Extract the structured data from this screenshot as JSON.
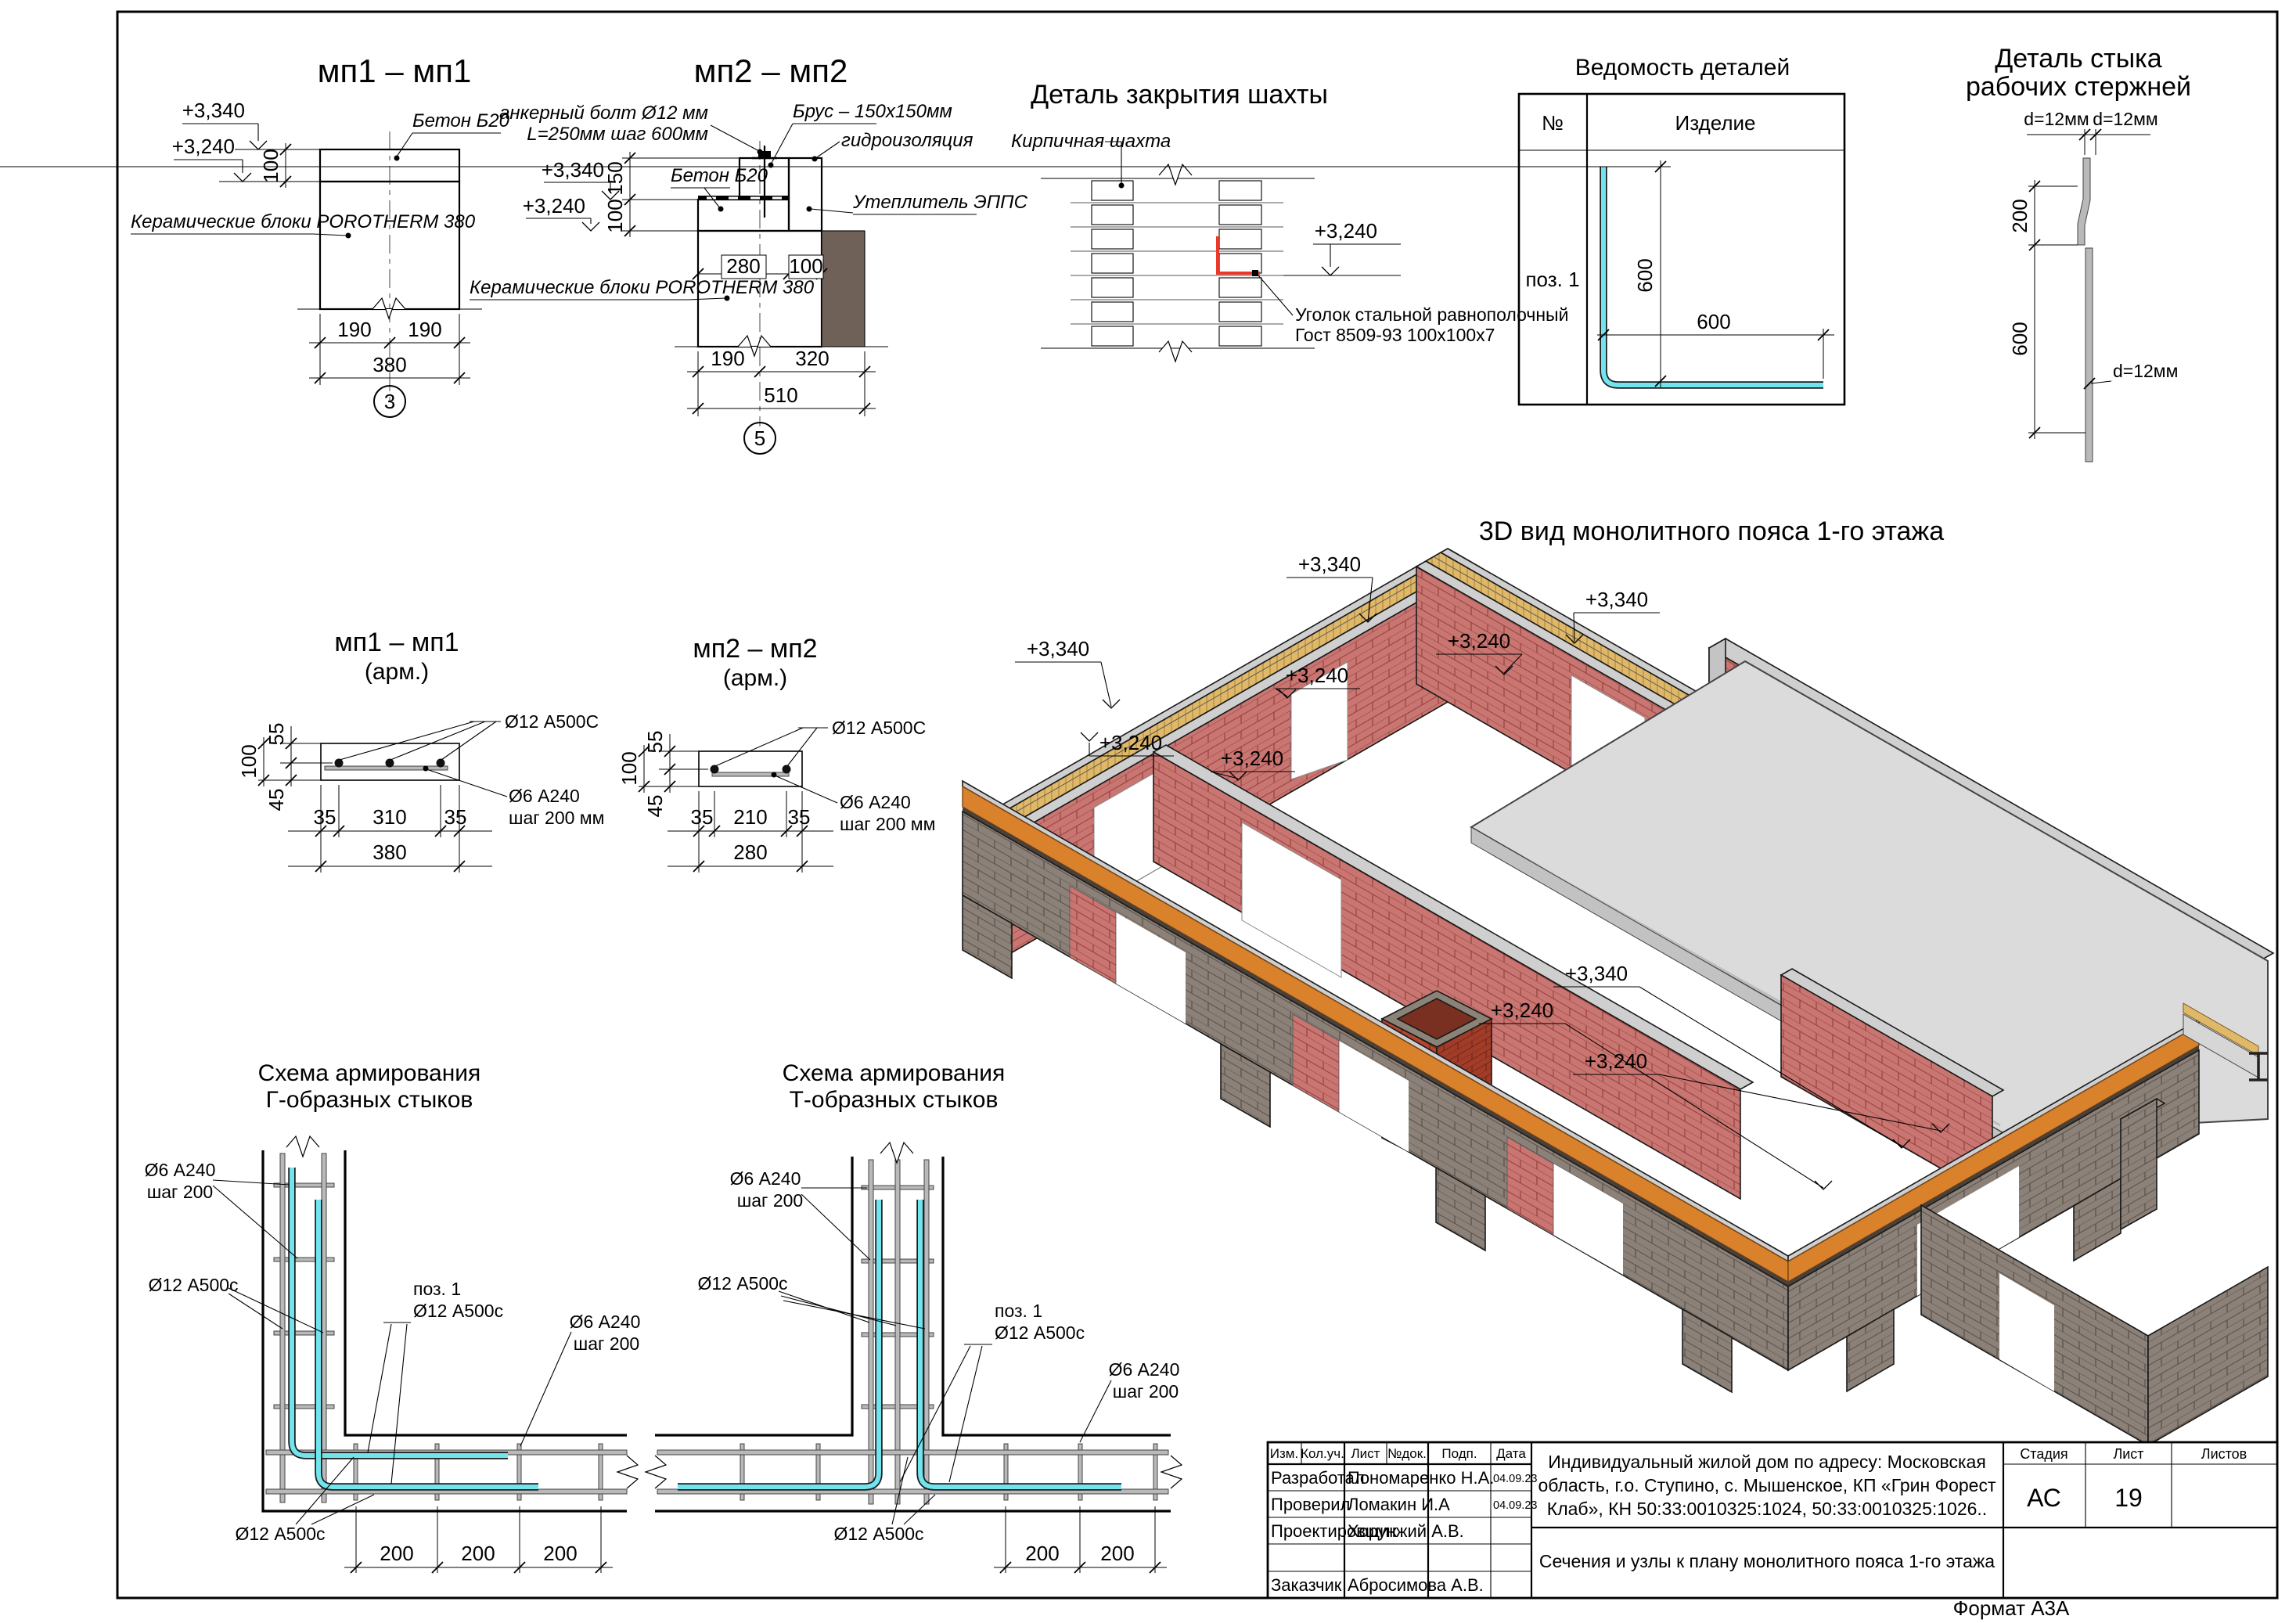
{
  "colors": {
    "brick": "#c97672",
    "brickline": "#96413c",
    "bricksec": "#c9807a",
    "hatchblue": "#98a0b8",
    "fnd": "#8b8178",
    "fndline": "#5b534b",
    "belt": "#d9822b",
    "wood": "#dfb869",
    "woodline": "#ad873c",
    "concrete": "#d8d8d8",
    "concline": "#8f8f8f",
    "slab": "#dbdbdb",
    "insul": "#6f6058",
    "hydro": "#d08038",
    "hydroline": "#7c4a1c",
    "rebar": "#72e4ee",
    "highlight": "#e8392a",
    "chimA": "#b5452f",
    "chimB": "#a03c28",
    "chimline": "#6e2418"
  },
  "frame": {
    "format": "Формат А3А"
  },
  "mp1": {
    "title": "мп1 – мп1",
    "concrete": "Бетон Б20",
    "blocks": "Керамические блоки POROTHERM 380",
    "lvl_top": "+3,340",
    "lvl_bot": "+3,240",
    "d100": "100",
    "d190l": "190",
    "d190r": "190",
    "d380": "380",
    "marker": "3"
  },
  "mp2": {
    "title": "мп2 – мп2",
    "anchor1": "анкерный болт Ø12 мм",
    "anchor2": "L=250мм шаг 600мм",
    "beam": "Брус – 150х150мм",
    "waterproofing": "гидроизоляция",
    "concrete": "Бетон Б20",
    "insulation": "Утеплитель ЭППС",
    "blocks": "Керамические блоки POROTHERM 380",
    "lvl_top": "+3,340",
    "lvl_bot": "+3,240",
    "d150": "150",
    "d100": "100",
    "d280": "280",
    "d100b": "100",
    "d190": "190",
    "d320": "320",
    "d510": "510",
    "marker": "5"
  },
  "shaft": {
    "title": "Деталь закрытия шахты",
    "wall": "Кирпичная шахта",
    "lvl": "+3,240",
    "angle1": "Уголок стальной равнополочный",
    "angle2": "Гост 8509-93 100х100х7"
  },
  "parts": {
    "title": "Ведомость деталей",
    "no": "№",
    "item": "Изделие",
    "pos": "поз. 1",
    "dv": "600",
    "dh": "600"
  },
  "rods": {
    "title1": "Деталь стыка",
    "title2": "рабочих стержней",
    "d1": "d=12мм",
    "d2": "d=12мм",
    "d3": "d=12мм",
    "d200": "200",
    "d600": "600"
  },
  "view3d": {
    "title": "3D вид монолитного пояса 1-го этажа",
    "levels": [
      {
        "t": "+3,340"
      },
      {
        "t": "+3,340"
      },
      {
        "t": "+3,240"
      },
      {
        "t": "+3,340"
      },
      {
        "t": "+3,240"
      },
      {
        "t": "+3,240"
      },
      {
        "t": "+3,240"
      },
      {
        "t": "+3,340"
      },
      {
        "t": "+3,240"
      },
      {
        "t": "+3,240"
      }
    ]
  },
  "mp1a": {
    "title": "мп1 – мп1",
    "sub": "(арм.)",
    "bar": "Ø12 А500С",
    "tie1": "Ø6 А240",
    "tie2": "шаг 200 мм",
    "d55": "55",
    "d100": "100",
    "d45": "45",
    "d35l": "35",
    "d310": "310",
    "d35r": "35",
    "d380": "380"
  },
  "mp2a": {
    "title": "мп2 – мп2",
    "sub": "(арм.)",
    "bar": "Ø12 А500С",
    "tie1": "Ø6 А240",
    "tie2": "шаг 200 мм",
    "d55": "55",
    "d100": "100",
    "d45": "45",
    "d35l": "35",
    "d210": "210",
    "d35r": "35",
    "d280": "280"
  },
  "schL": {
    "t1": "Схема армирования",
    "t2": "Г-образных стыков",
    "tieTop1": "Ø6 А240",
    "tieTop2": "шаг 200",
    "barL": "Ø12 А500с",
    "pos1": "поз. 1",
    "pos2": "Ø12 А500с",
    "tieR1": "Ø6 А240",
    "tieR2": "шаг 200",
    "barB": "Ø12 А500с",
    "d1": "200",
    "d2": "200",
    "d3": "200"
  },
  "schT": {
    "t1": "Схема армирования",
    "t2": "Т-образных стыков",
    "tieTop1": "Ø6 А240",
    "tieTop2": "шаг 200",
    "barL": "Ø12 А500с",
    "pos1": "поз. 1",
    "pos2": "Ø12 А500с",
    "tieR1": "Ø6 А240",
    "tieR2": "шаг 200",
    "barB": "Ø12 А500с",
    "d1": "200",
    "d2": "200"
  },
  "tb": {
    "h": [
      "Изм.",
      "Кол.уч.",
      "Лист",
      "№док.",
      "Подп.",
      "Дата"
    ],
    "rows": [
      {
        "r": "Разработал",
        "n": "Пономаренко Н.А.",
        "d": "04.09.23"
      },
      {
        "r": "Проверил",
        "n": "Ломакин И.А",
        "d": "04.09.23"
      },
      {
        "r": "Проектировщик",
        "n": "Хорунжий А.В.",
        "d": ""
      },
      {
        "r": "",
        "n": "",
        "d": ""
      },
      {
        "r": "Заказчик",
        "n": "Абросимова А.В.",
        "d": ""
      }
    ],
    "p1": "Индивидуальный жилой дом по адресу: Московская",
    "p2": "область, г.о. Ступино, с. Мышенское, КП «Грин Форест",
    "p3": "Клаб», КН 50:33:0010325:1024, 50:33:0010325:1026..",
    "doc": "Сечения и узлы к плану монолитного пояса 1-го этажа",
    "stage_l": "Стадия",
    "sheet_l": "Лист",
    "sheets_l": "Листов",
    "stage": "АС",
    "sheet": "19",
    "sheets": ""
  }
}
